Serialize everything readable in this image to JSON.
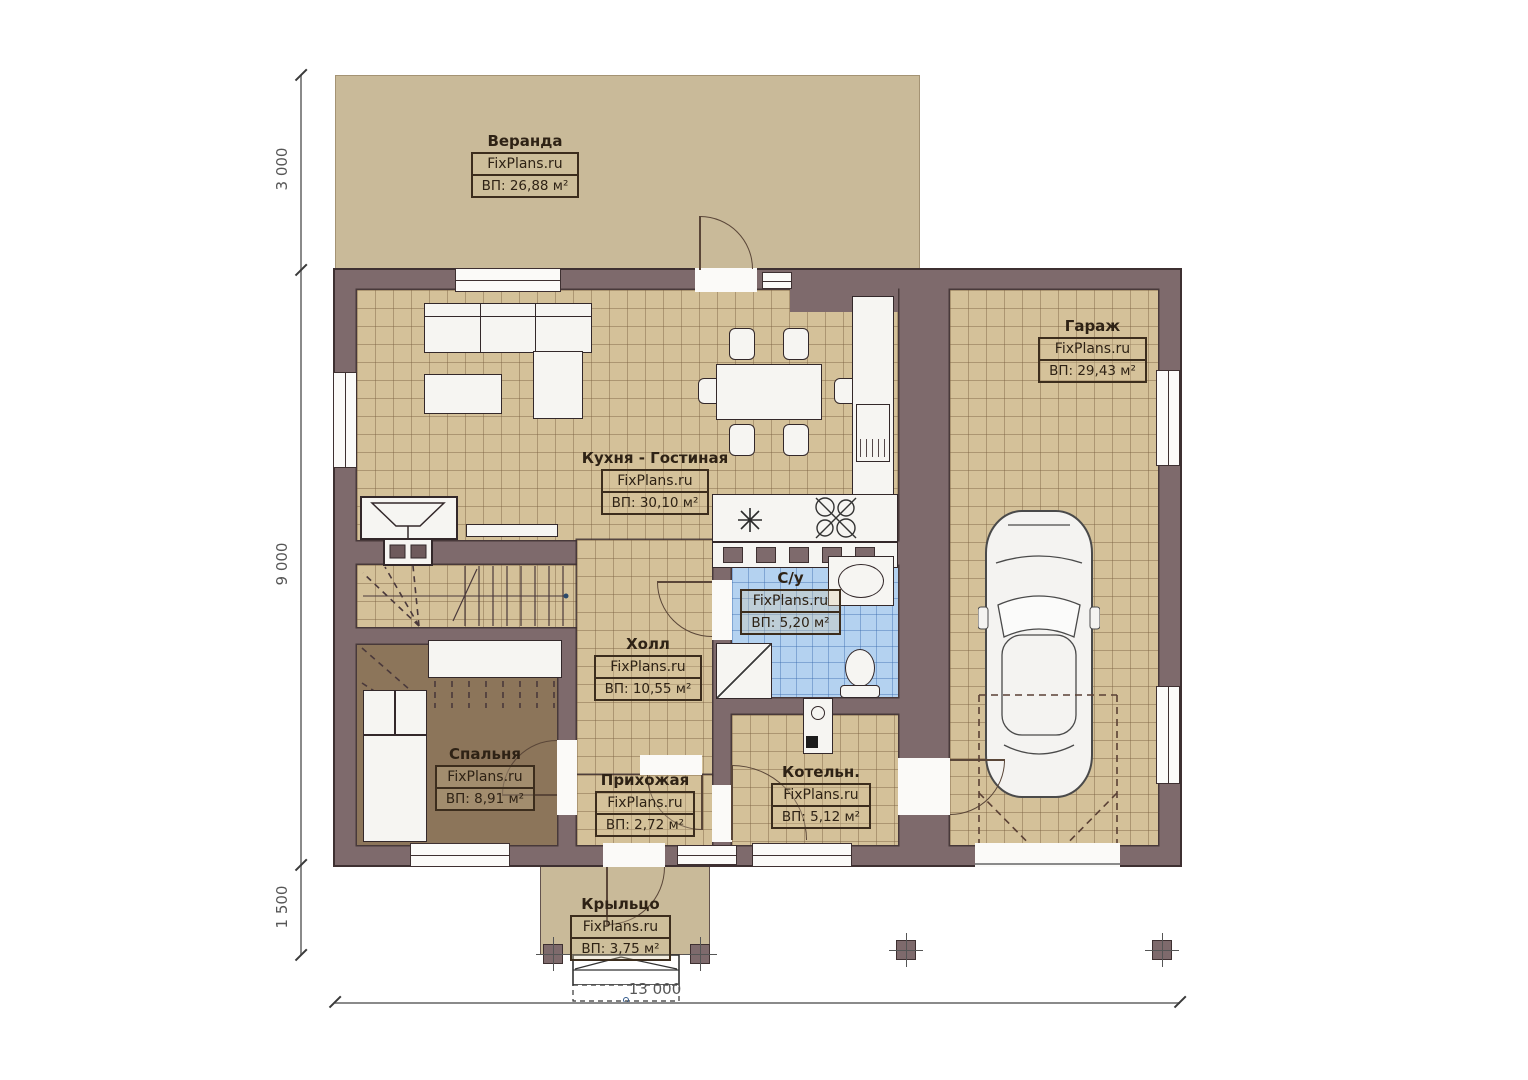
{
  "plan": {
    "site": "FixPlans.ru",
    "rooms": [
      {
        "key": "veranda",
        "name": "Веранда",
        "watermark": "FixPlans.ru",
        "area": "ВП: 26,88 м²"
      },
      {
        "key": "garage",
        "name": "Гараж",
        "watermark": "FixPlans.ru",
        "area": "ВП: 29,43 м²"
      },
      {
        "key": "kitchen_living",
        "name": "Кухня - Гостиная",
        "watermark": "FixPlans.ru",
        "area": "ВП: 30,10 м²"
      },
      {
        "key": "bathroom",
        "name": "С/у",
        "watermark": "FixPlans.ru",
        "area": "ВП: 5,20 м²"
      },
      {
        "key": "hall",
        "name": "Холл",
        "watermark": "FixPlans.ru",
        "area": "ВП: 10,55 м²"
      },
      {
        "key": "bedroom",
        "name": "Спальня",
        "watermark": "FixPlans.ru",
        "area": "ВП: 8,91 м²"
      },
      {
        "key": "entry",
        "name": "Прихожая",
        "watermark": "FixPlans.ru",
        "area": "ВП: 2,72 м²"
      },
      {
        "key": "boiler",
        "name": "Котельн.",
        "watermark": "FixPlans.ru",
        "area": "ВП: 5,12 м²"
      },
      {
        "key": "porch",
        "name": "Крыльцо",
        "watermark": "FixPlans.ru",
        "area": "ВП: 3,75 м²"
      }
    ],
    "dimensions": {
      "left_top": "3 000",
      "left_middle": "9 000",
      "left_bottom": "1 500",
      "bottom_total": "13 000"
    },
    "colors": {
      "wall": "#7e6a6c",
      "wall_outline": "#3e3031",
      "floor_tile": "#d4c199",
      "veranda_fill": "#c9ba99",
      "bedroom_floor": "#8c755a",
      "bathroom_tile": "#b4d2f0",
      "fixture_white": "#f6f5f2",
      "label_text": "#2e2215"
    }
  }
}
